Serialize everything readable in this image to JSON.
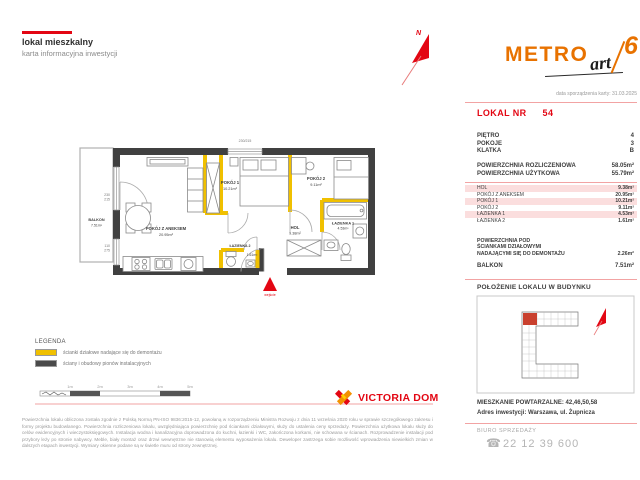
{
  "header": {
    "title": "lokal mieszkalny",
    "subtitle": "karta informacyjna inwestycji"
  },
  "logo": {
    "metro": "METRO",
    "art": "art",
    "number": "6"
  },
  "card": {
    "date_note": "data sporządzenia karty: 31.03.2025"
  },
  "unit": {
    "label": "LOKAL NR",
    "number": "54",
    "attributes": [
      {
        "label": "PIĘTRO",
        "value": "4"
      },
      {
        "label": "POKOJE",
        "value": "3"
      },
      {
        "label": "KLATKA",
        "value": "B"
      }
    ],
    "areas": [
      {
        "label": "POWIERZCHNIA ROZLICZENIOWA",
        "value": "58.05m²"
      },
      {
        "label": "POWIERZCHNIA UŻYTKOWA",
        "value": "55.79m²"
      }
    ],
    "rooms": [
      {
        "name": "HOL",
        "area": "9.38m²"
      },
      {
        "name": "POKÓJ Z ANEKSEM",
        "area": "20.95m²"
      },
      {
        "name": "POKÓJ 1",
        "area": "10.21m²"
      },
      {
        "name": "POKÓJ 2",
        "area": "9.11m²"
      },
      {
        "name": "ŁAZIENKA 1",
        "area": "4.53m²"
      },
      {
        "name": "ŁAZIENKA 2",
        "area": "1.61m²"
      }
    ],
    "partition_lines": [
      "POWIERZCHNIA POD",
      "ŚCIANKAMI DZIAŁOWYMI",
      "NADAJĄCYMI SIĘ DO DEMONTAŻU"
    ],
    "partition_value": "2.26m²",
    "balcony_label": "BALKON",
    "balcony_value": "7.51m²"
  },
  "plan": {
    "window_dims": [
      "230",
      "215",
      "110",
      "275",
      "230/215"
    ],
    "entrance_label": "wejście",
    "north": "N"
  },
  "location": {
    "heading": "POŁOŻENIE LOKALU W BUDYNKU",
    "repeat_note": "MIESZKANIE POWTARZALNE: 42,46,50,58",
    "address": "Adres inwestycji: Warszawa, ul. Żupnicza"
  },
  "legend": {
    "heading": "LEGENDA",
    "items": [
      {
        "label": "ścianki działowe nadające się do demontażu"
      },
      {
        "label": "ściany i obudowy pionów instalacyjnych"
      }
    ]
  },
  "scalebar": [
    "1m",
    "2m",
    "3m",
    "4m",
    "5m"
  ],
  "sales": {
    "label": "BIURO SPRZEDAŻY",
    "phone": "22 12 39 600"
  },
  "developer": {
    "name": "VICTORIA DOM"
  },
  "icons": {
    "phone": "☎"
  },
  "disclaimer": "Powierzchnia lokalu obliczona została zgodnie z Polską Normą PN-ISO 9836:2015-12, powołaną w rozporządzeniu Ministra Rozwoju z dnia 11 września 2020 roku w sprawie szczegółowego zakresu i formy projektu budowlanego. Powierzchnia rozliczeniowa lokalu, uwzględniająca powierzchnię pod ściankami działowymi, służy do ustalenia ceny sprzedaży. Powierzchnia użytkowa lokalu służy do celów ewidencyjnych i wieczystoksięgowych. Instalacja wodna i kanalizacyjna doprowadzona do kuchni, łazienki i WC, zakończona korkami, nie schowana w ścianach. Rozprowadzenie instalacji pod przybory leży po stronie nabywcy. Meble, biały montaż oraz drzwi wewnętrzne nie stanowią elementu wyposażenia lokalu. Deweloper zastrzega sobie możliwość wprowadzenia niewielkich zmian w dalszych etapach inwestycji. Wymiary okienne podane są w świetle muru od strony zewnętrznej.",
  "colors": {
    "accent_red": "#e30613",
    "logo_orange": "#e87200",
    "wall_dark": "#404040",
    "partition_yellow": "#f0c000",
    "row_pink": "#fbdede",
    "rule_pink": "#f2a3a3",
    "unit_highlight": "#c9402e"
  }
}
